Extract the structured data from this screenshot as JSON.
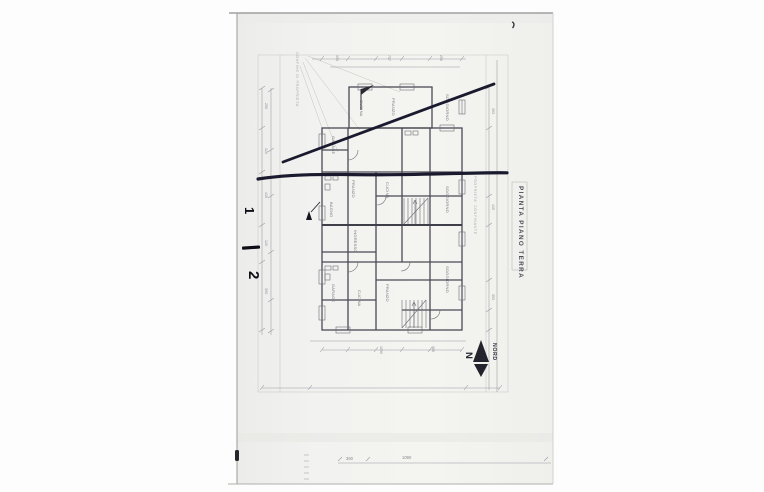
{
  "document": {
    "kind": "scanned architectural drawing",
    "title_block": {
      "title": "PIANTA PIANO TERRA"
    },
    "compass": {
      "letter": "N",
      "label": "NORD"
    },
    "handwritten": {
      "mark1": "1",
      "mark2": "2"
    },
    "outer_dimensions": {
      "dim_small": "360",
      "dim_large": "1090"
    },
    "annotations": {
      "left_boundary": "CONFINE DI PROPRIETA'",
      "right_boundary": "PROPRIETA' CONFINANTE"
    },
    "colors": {
      "sheet": "#f1f1ee",
      "marker_ink": "#1a1a2f",
      "pen_ink": "#0e0e16",
      "plan_line": "#9a9aa2",
      "wall_line": "#4a4a55"
    }
  },
  "plan": {
    "room_labels": [
      {
        "t": "CUCINA",
        "x": 360,
        "y": 100
      },
      {
        "t": "PRANZO",
        "x": 392,
        "y": 98
      },
      {
        "t": "SOGGIORNO",
        "x": 446,
        "y": 94
      },
      {
        "t": "GARAGE",
        "x": 332,
        "y": 136
      },
      {
        "t": "PRANZO",
        "x": 352,
        "y": 180
      },
      {
        "t": "CUCINA",
        "x": 386,
        "y": 182
      },
      {
        "t": "SOGGIORNO",
        "x": 446,
        "y": 186
      },
      {
        "t": "BAGNO",
        "x": 330,
        "y": 202
      },
      {
        "t": "INGRESSO",
        "x": 354,
        "y": 230
      },
      {
        "t": "SOGGIORNO",
        "x": 446,
        "y": 266
      },
      {
        "t": "PRANZO",
        "x": 386,
        "y": 284
      },
      {
        "t": "CUCINA",
        "x": 358,
        "y": 290
      },
      {
        "t": "GARAGE",
        "x": 332,
        "y": 284
      }
    ],
    "dim_marks": [
      {
        "t": "250",
        "x": 265,
        "y": 103
      },
      {
        "t": "120",
        "x": 265,
        "y": 148
      },
      {
        "t": "415",
        "x": 265,
        "y": 192
      },
      {
        "t": "120",
        "x": 265,
        "y": 240
      },
      {
        "t": "393",
        "x": 265,
        "y": 288
      },
      {
        "t": "193",
        "x": 336,
        "y": 55
      },
      {
        "t": "757",
        "x": 388,
        "y": 55
      },
      {
        "t": "250",
        "x": 440,
        "y": 55
      },
      {
        "t": "393",
        "x": 492,
        "y": 108
      },
      {
        "t": "415",
        "x": 492,
        "y": 204
      },
      {
        "t": "393",
        "x": 492,
        "y": 294
      },
      {
        "t": "1090",
        "x": 380,
        "y": 346
      },
      {
        "t": "360",
        "x": 432,
        "y": 346
      }
    ]
  }
}
